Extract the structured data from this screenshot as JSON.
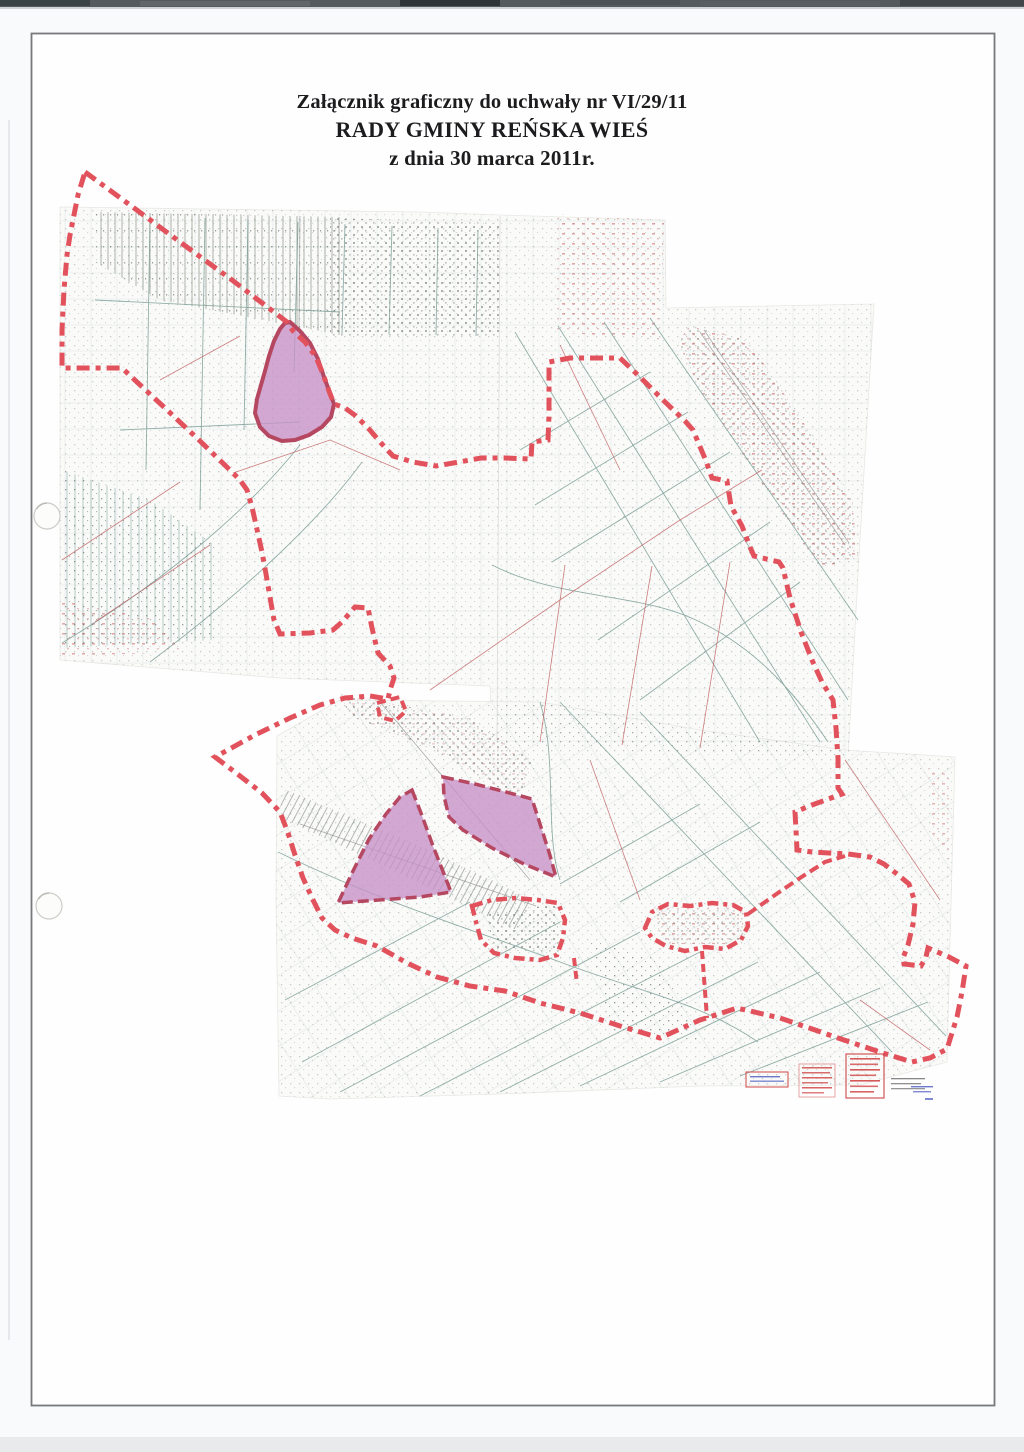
{
  "document": {
    "title_line1": "Załącznik graficzny do uchwały nr VI/29/11",
    "title_line2": "RADY GMINY REŃSKA WIEŚ",
    "title_line3": "z dnia 30 marca 2011r."
  },
  "map": {
    "colors": {
      "boundary": "#e2525c",
      "highlight_fill": "#c791c8",
      "highlight_outline": "#b54760",
      "map_teal": "#6f958d",
      "map_red": "#c06060",
      "map_gray": "#8a8a8a",
      "sheet": "#fafaf9",
      "sheet_edge": "#e8e8e4",
      "frame": "#77797b",
      "stamp_red": "#d04848",
      "stamp_blue": "#4a58c0"
    },
    "sheets": {
      "upper": "60,207 420,212 500,215 665,220 666,308 874,304 859,556 848,757 540,748 492,743 490,686 280,678 60,660",
      "lower": "277,736 340,700 540,702 700,730 845,750 955,757 950,940 947,1062 860,1085 700,1086 500,1094 330,1099 279,1096 276,900"
    },
    "boundary": {
      "outer": "85,172 130,205 180,242 232,280 287,322 293,331 305,342 316,357 323,374 329,391 334,404 345,408 356,416 369,429 381,443 393,456 413,462 436,466 459,462 481,458 504,458 531,459 532,442 548,440 549,415 549,362 570,358 596,358 620,358 641,378 663,400 685,421 693,430 706,461 712,478 727,481 731,506 742,526 750,547 754,556 779,562 783,568 790,598 801,632 812,660 822,682 833,700 836,728 838,758 838,788 842,794 812,805 795,812 796,830 797,850 812,852 848,854 870,857 884,864 897,874 909,884 915,902 913,924 908,945 903,958 904,964 921,966 926,957 928,948 949,957 966,966 962,992 957,1017 947,1049 930,1058 912,1062 886,1054 862,1046 838,1038 818,1031 780,1018 737,1008 700,1020 660,1038 620,1026 580,1013 540,1003 505,991 470,986 437,977 407,963 377,946 352,938 335,930 322,918 313,900 303,878 295,855 288,833 280,812 262,793 240,776 215,757 255,735 290,718 320,705 345,698 370,696 388,699 390,690 392,684 394,678 390,666 378,653 372,628 368,608 355,607 342,622 333,630 310,633 280,634 274,620 271,603 266,574 262,552 258,534 252,507 247,490 240,480 233,473 200,441 165,408 138,383 122,368 95,368 62,368 62,330 64,290 67,255 70,235 78,195",
      "enclaves": [
        {
          "name": "village-enclave-west",
          "points": "472,906 492,900 515,898 538,900 558,903 565,920 563,938 557,955 540,960 515,958 494,953 481,940 476,922"
        },
        {
          "name": "village-enclave-east",
          "points": "645,928 652,912 668,904 690,906 712,903 733,905 746,912 748,926 741,940 725,949 705,947 685,951 666,946 652,938"
        },
        {
          "name": "village-enclave-small",
          "points": "377,703 400,697 406,711 395,721 380,717"
        }
      ],
      "connectors": [
        {
          "name": "connector-west",
          "points": "574,958 577,984"
        },
        {
          "name": "connector-south",
          "points": "702,951 707,1018"
        },
        {
          "name": "connector-northeast",
          "points": "748,914 775,895 800,878 825,862 845,856"
        }
      ]
    },
    "highlights": [
      {
        "name": "highlighted-area-north",
        "points": "290,322 300,331 310,343 318,359 324,377 330,393 334,404 331,417 322,427 309,435 295,440 282,441 269,436 260,427 255,413 257,399 261,385 265,371 269,356 274,341 280,329 285,323",
        "outline_style": "solid"
      },
      {
        "name": "highlighted-area-southwest",
        "points": "412,790 421,813 433,846 444,874 451,892 420,897 379,900 338,903 353,871 369,839 386,814 400,797",
        "outline_style": "dashed"
      },
      {
        "name": "highlighted-area-southeast",
        "points": "443,777 475,784 506,792 532,799 540,824 549,852 556,877 524,864 492,848 463,830 449,817 444,796",
        "outline_style": "dashed"
      }
    ],
    "stamps": [
      {
        "name": "boxed-stamp-blue-text",
        "legible": false,
        "color": "#d04848"
      },
      {
        "name": "red-text-stamp-1",
        "legible": false,
        "color": "#d04848"
      },
      {
        "name": "red-text-stamp-2",
        "legible": false,
        "color": "#d04848"
      },
      {
        "name": "gray-blue-annotation",
        "legible": false,
        "color": "#4a58c0"
      }
    ]
  },
  "artifacts": {
    "hole_punch_count": 2,
    "scanner_band": "top-edge",
    "page_frame": true
  }
}
